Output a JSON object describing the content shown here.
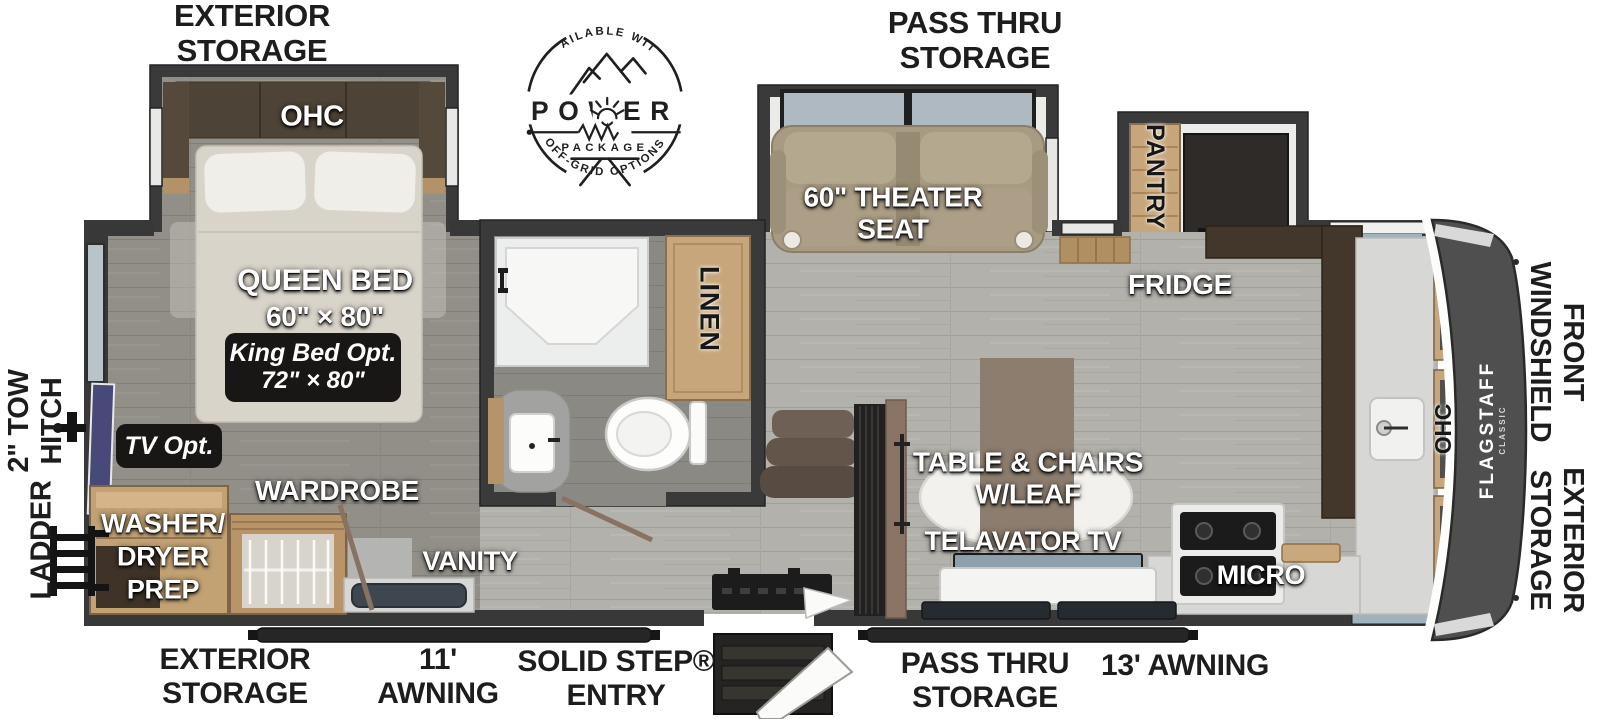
{
  "exterior": {
    "storage_top": "EXTERIOR\nSTORAGE",
    "pass_thru_top": "PASS THRU\nSTORAGE",
    "tow_hitch": "2\" TOW\nHITCH",
    "ladder": "LADDER",
    "front_windshield": "FRONT\nWINDSHIELD",
    "exterior_storage_front": "EXTERIOR\nSTORAGE",
    "storage_bottom": "EXTERIOR\nSTORAGE",
    "awning_11": "11'\nAWNING",
    "solid_step": "SOLID STEP®\nENTRY",
    "pass_thru_bottom": "PASS THRU\nSTORAGE",
    "awning_13": "13' AWNING"
  },
  "badge": {
    "available_with": "AVAILABLE WITH",
    "power": "POWER",
    "package": "PACKAGE",
    "off_grid": "OFF-GRID OPTIONS"
  },
  "bedroom": {
    "ohc": "OHC",
    "queen_bed": "QUEEN BED",
    "queen_size": "60\" × 80\"",
    "king_opt": "King Bed Opt.",
    "king_size": "72\" × 80\"",
    "tv_opt": "TV Opt.",
    "wardrobe": "WARDROBE",
    "washer_dryer": "WASHER/\nDRYER\nPREP",
    "vanity": "VANITY"
  },
  "bathroom": {
    "linen": "LINEN"
  },
  "living": {
    "theater_seat": "60\" THEATER\nSEAT",
    "pantry": "PANTRY",
    "fridge": "FRIDGE",
    "table_chairs": "TABLE & CHAIRS\nW/LEAF",
    "telavator_tv": "TELAVATOR TV",
    "micro": "MICRO",
    "ohc_front": "OHC"
  },
  "brand": {
    "name": "FLAGSTAFF",
    "series": "CLASSIC"
  },
  "colors": {
    "wall": "#383838",
    "floor_living": "#b1afa9",
    "floor_bedroom": "#908e87",
    "wood": "#c7a67b",
    "wood_dark": "#43362b",
    "front_cap": "#4f4f4f",
    "option_box": "#191715"
  }
}
